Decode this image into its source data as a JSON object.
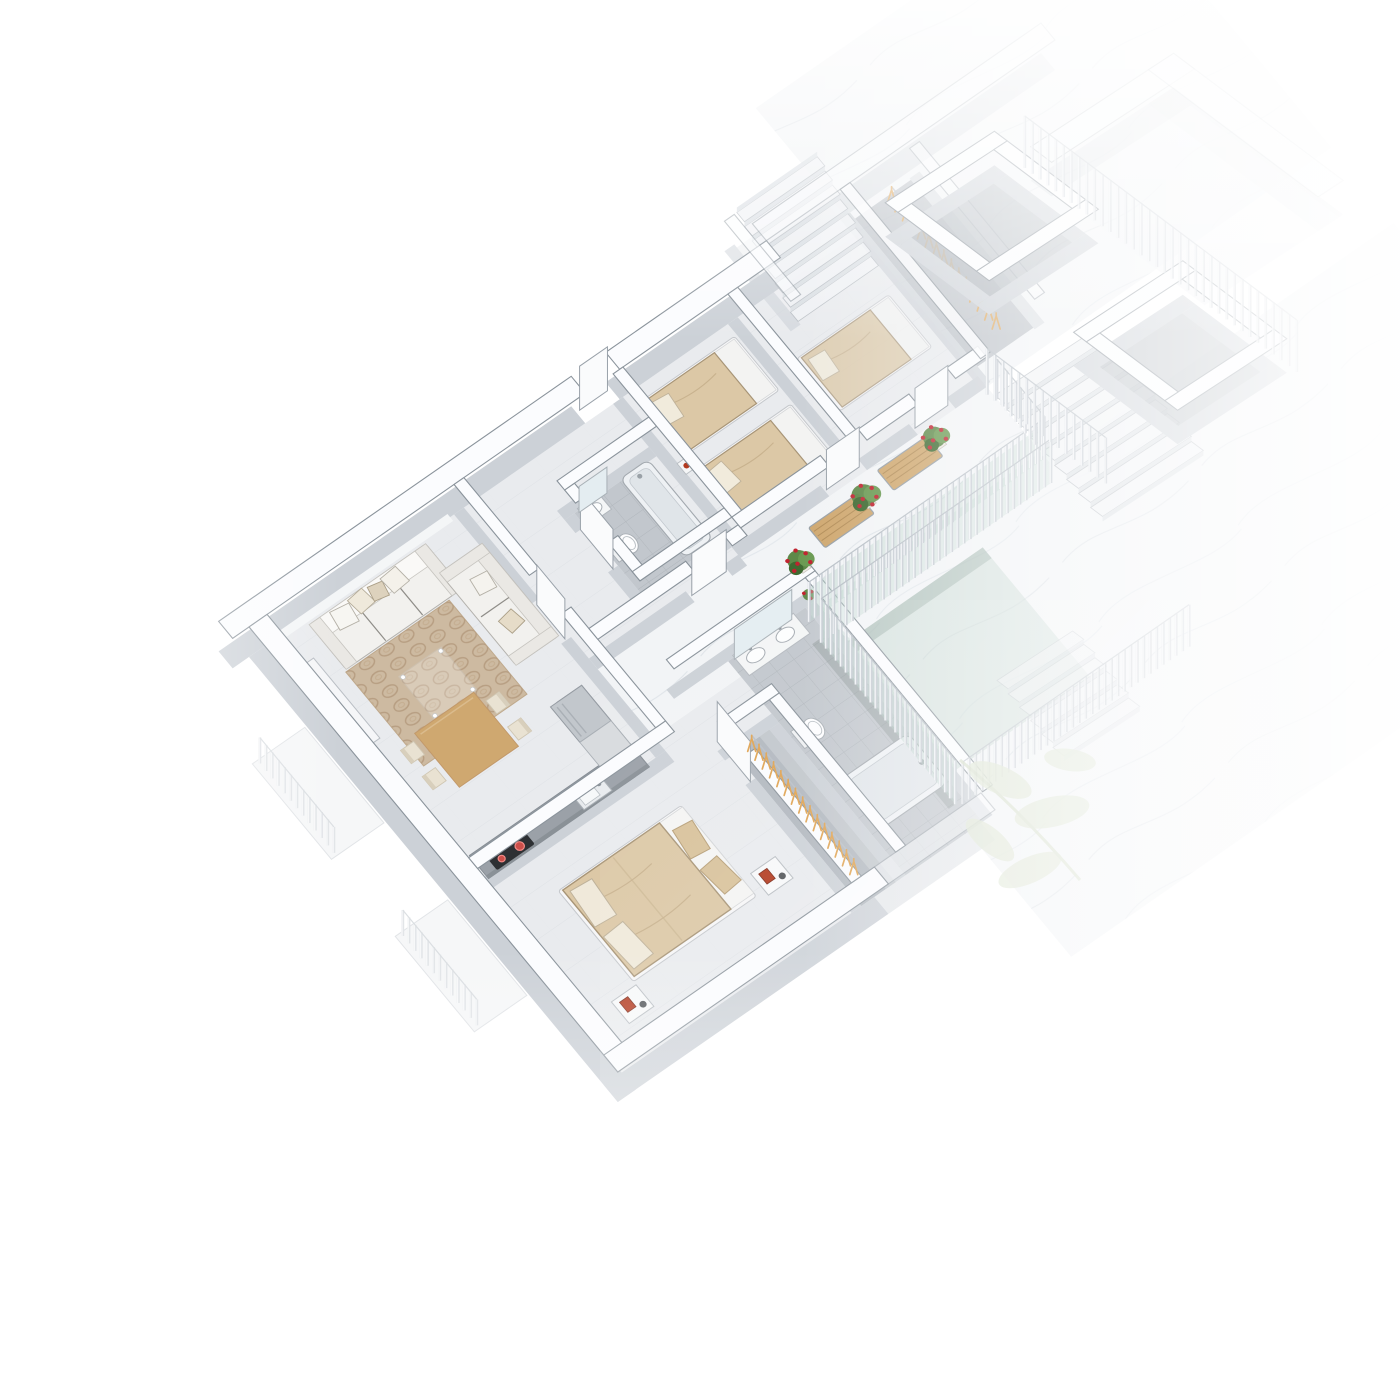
{
  "scene": {
    "type": "isometric-3d-floor-plan-render",
    "style": "white architectural visualization, cut-wall axonometric view, edges fade to white",
    "rooms": [
      {
        "name": "living-room",
        "items": [
          "three-seat-sofa",
          "two-seat-sofa",
          "throw-pillows",
          "patterned-rug",
          "glass-coffee-table",
          "dining-table",
          "dining-chairs-x4",
          "sideboard"
        ]
      },
      {
        "name": "kitchen",
        "items": [
          "counter",
          "induction-cooktop-red-burners",
          "sink",
          "fridge",
          "tall-cabinet"
        ]
      },
      {
        "name": "master-bedroom",
        "items": [
          "double-bed-beige-duvet",
          "pillows",
          "foot-cushions",
          "nightstand-x2",
          "red-flower-art"
        ]
      },
      {
        "name": "master-walk-in-closet",
        "items": [
          "hanger-rail",
          "wooden-hangers"
        ]
      },
      {
        "name": "main-bathroom",
        "items": [
          "double-vanity",
          "mirror",
          "toilet",
          "bathtub"
        ]
      },
      {
        "name": "small-bathroom",
        "items": [
          "washbasin",
          "mirror",
          "toilet",
          "bathtub"
        ]
      },
      {
        "name": "bedroom-2",
        "items": [
          "single-bed",
          "single-bed",
          "bedside-unit"
        ]
      },
      {
        "name": "bedroom-3",
        "items": [
          "single-bed"
        ]
      },
      {
        "name": "terrace-walkway",
        "items": [
          "wooden-bench-x2",
          "potted-red-roses-x3",
          "vertical-slat-railing",
          "glass-balustrade"
        ]
      },
      {
        "name": "stairwell",
        "items": [
          "stairs-down",
          "slat-balustrade",
          "glass-void",
          "marble-floor"
        ]
      },
      {
        "name": "neighbor-unit",
        "items": [
          "stairs-up",
          "hanger-closet",
          "single-bed-faded"
        ]
      },
      {
        "name": "elevator-shafts",
        "items": [
          "open-shaft",
          "open-shaft"
        ]
      },
      {
        "name": "balconies-left",
        "items": [
          "balcony-slab",
          "railing-bars",
          "balcony-slab",
          "railing-bars"
        ]
      },
      {
        "name": "ghost-foliage",
        "items": [
          "pale-leaf-branch"
        ]
      }
    ]
  },
  "palette": {
    "wood": "#cfa870",
    "wood_dark": "#b28d58",
    "rug": "#cdbaa1",
    "rug_pattern": "#b79e82",
    "duvet": "#dcc8a6",
    "cushion": "#d8c29b",
    "slat": "#f0f2f5",
    "slat_shadow": "#c6ccd3",
    "hanger": "#dfa352",
    "flower": "#c0232f",
    "plant": "#55833f",
    "plant_dark": "#3f6a31",
    "plant_light": "#6a9a52",
    "floor": "#e9ebee",
    "bath_floor": "#c2c7cd",
    "closet_floor": "#b2b8bf",
    "marble": "#f2f4f6",
    "wall_top": "#fbfcfe",
    "wall_edge": "#8a939b",
    "wall_side": "#ccd1d7",
    "outer_side": "#dde1e5",
    "counter": "#9ba1a8",
    "steel": "#c2c7cc",
    "cooktop": "#2d3033",
    "burner": "#cc4f4a",
    "burner_ring": "#f08a86",
    "white_fabric": "#f2f1ee",
    "frame_white": "#f6f6f7",
    "red_decor": "#b23a1f",
    "teal_glass": "#b8cfc6",
    "ghost_leaf": "#dde5d2"
  },
  "geometry": {
    "matrix_main": [
      0.82,
      -0.57,
      0.638,
      0.77,
      235,
      640
    ],
    "matrix_wing": [
      0.84,
      -0.55,
      0.8,
      0.6,
      235,
      640
    ],
    "wall_height": 30,
    "door_height": 40,
    "shaft_wall_height": 34,
    "furniture_lift": 5
  }
}
